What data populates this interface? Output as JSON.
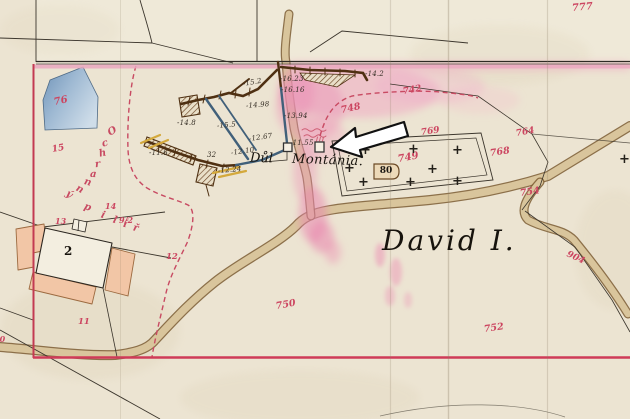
{
  "map": {
    "region_label": "David I.",
    "mine_label": {
      "word1": "Důl",
      "word2": "Montánia."
    },
    "building_label": "2",
    "tag_label": "80",
    "pillar_label": {
      "word1": "Ochranný",
      "word2": "pilíř"
    },
    "pillar_letters": [
      {
        "t": "O",
        "x": 111,
        "y": 133,
        "r": -30
      },
      {
        "t": "c",
        "x": 105,
        "y": 145,
        "r": -18
      },
      {
        "t": "h",
        "x": 102,
        "y": 155,
        "r": -12
      },
      {
        "t": "r",
        "x": 98,
        "y": 166,
        "r": -6
      },
      {
        "t": "a",
        "x": 93,
        "y": 176,
        "r": 4
      },
      {
        "t": "n",
        "x": 87,
        "y": 184,
        "r": 16
      },
      {
        "t": "n",
        "x": 79,
        "y": 191,
        "r": 28
      },
      {
        "t": "ý",
        "x": 69,
        "y": 196,
        "r": 38
      },
      {
        "t": "p",
        "x": 87,
        "y": 209,
        "r": 20
      },
      {
        "t": "i",
        "x": 104,
        "y": 217,
        "r": 18
      },
      {
        "t": "l",
        "x": 116,
        "y": 222,
        "r": 16
      },
      {
        "t": "í",
        "x": 126,
        "y": 226,
        "r": 14
      },
      {
        "t": "ř",
        "x": 136,
        "y": 230,
        "r": 14
      }
    ],
    "measurements": [
      {
        "t": "-15.2",
        "x": 243,
        "y": 80,
        "r": -10
      },
      {
        "t": "-16.23",
        "x": 280,
        "y": 75,
        "r": 0
      },
      {
        "t": "-16.16",
        "x": 281,
        "y": 86,
        "r": 0
      },
      {
        "t": "-14.2",
        "x": 365,
        "y": 70,
        "r": 0
      },
      {
        "t": "-14.98",
        "x": 246,
        "y": 102,
        "r": -5
      },
      {
        "t": "-13.94",
        "x": 284,
        "y": 112,
        "r": 0
      },
      {
        "t": "-14.8",
        "x": 177,
        "y": 119,
        "r": 0
      },
      {
        "t": "-15.5",
        "x": 217,
        "y": 122,
        "r": -5
      },
      {
        "t": "-12.67",
        "x": 249,
        "y": 135,
        "r": -8
      },
      {
        "t": "-11.55",
        "x": 290,
        "y": 139,
        "r": 0
      },
      {
        "t": "-11.6",
        "x": 149,
        "y": 149,
        "r": 0
      },
      {
        "t": "32",
        "x": 207,
        "y": 151,
        "r": 0
      },
      {
        "t": "-12.10",
        "x": 231,
        "y": 149,
        "r": -8
      },
      {
        "t": "-12.24",
        "x": 218,
        "y": 167,
        "r": -5
      }
    ],
    "parcel_numbers": [
      {
        "t": "777",
        "x": 572,
        "y": 3,
        "r": -5,
        "s": 10
      },
      {
        "t": "742",
        "x": 403,
        "y": 87,
        "r": -10,
        "s": 9
      },
      {
        "t": "748",
        "x": 341,
        "y": 105,
        "r": -12,
        "s": 9.5
      },
      {
        "t": "769",
        "x": 421,
        "y": 128,
        "r": -8,
        "s": 9
      },
      {
        "t": "764",
        "x": 516,
        "y": 129,
        "r": -10,
        "s": 9
      },
      {
        "t": "768",
        "x": 490,
        "y": 148,
        "r": -8,
        "s": 9.5
      },
      {
        "t": "749",
        "x": 398,
        "y": 154,
        "r": -10,
        "s": 10
      },
      {
        "t": "754",
        "x": 520,
        "y": 188,
        "r": -8,
        "s": 9.5
      },
      {
        "t": "904",
        "x": 567,
        "y": 249,
        "r": 25,
        "s": 9
      },
      {
        "t": "750",
        "x": 276,
        "y": 301,
        "r": -10,
        "s": 9.5
      },
      {
        "t": "752",
        "x": 484,
        "y": 324,
        "r": -8,
        "s": 9.5
      },
      {
        "t": "12",
        "x": 166,
        "y": 252,
        "r": 0,
        "s": 8.5
      },
      {
        "t": "13",
        "x": 55,
        "y": 216,
        "r": 0,
        "s": 8
      },
      {
        "t": "14",
        "x": 105,
        "y": 201,
        "r": 0,
        "s": 8
      },
      {
        "t": "9/2",
        "x": 119,
        "y": 215,
        "r": 0,
        "s": 8
      },
      {
        "t": "11",
        "x": 78,
        "y": 317,
        "r": 0,
        "s": 8.5
      },
      {
        "t": "15",
        "x": 52,
        "y": 145,
        "r": -10,
        "s": 9
      },
      {
        "t": "76",
        "x": 54,
        "y": 97,
        "r": -12,
        "s": 10
      },
      {
        "t": "10",
        "x": -6,
        "y": 334,
        "r": 0,
        "s": 8
      }
    ],
    "crosses": [
      {
        "t": "+",
        "x": 365,
        "y": 152
      },
      {
        "t": "+",
        "x": 413,
        "y": 151
      },
      {
        "t": "+",
        "x": 457,
        "y": 152
      },
      {
        "t": "+",
        "x": 349,
        "y": 170
      },
      {
        "t": "+",
        "x": 432,
        "y": 171
      },
      {
        "t": "+",
        "x": 363,
        "y": 184
      },
      {
        "t": "+",
        "x": 410,
        "y": 184
      },
      {
        "t": "+",
        "x": 457,
        "y": 183
      },
      {
        "t": "+",
        "x": 624,
        "y": 161
      }
    ],
    "colors": {
      "paper": "#ece4d2",
      "boundary_red": "#c53852",
      "parcel_number_red": "#cc4560",
      "road_tan": "#d9c59c",
      "tunnel_brown": "#4f3012",
      "water_blue": "#41607a",
      "pond_blue": "#8fb0cc",
      "wash_pink": "#f09ec0",
      "ink_black": "#2b2620",
      "building_salmon": "#f2c6a6",
      "arrow_fill": "#ffffff",
      "arrow_outline": "#111111"
    }
  }
}
